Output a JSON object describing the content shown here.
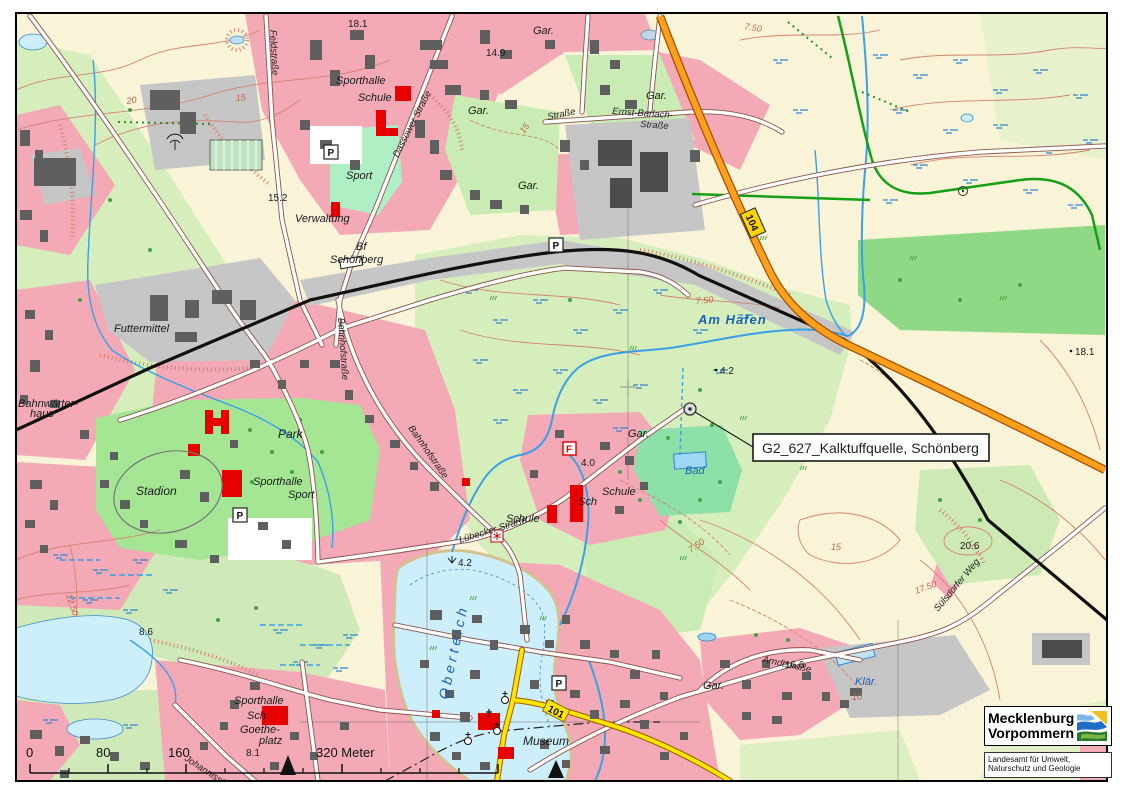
{
  "map": {
    "callout": "G2_627_Kalktuffquelle, Schönberg",
    "places": {
      "sporthalle": "Sporthalle",
      "schule": "Schule",
      "sport": "Sport",
      "verwaltung": "Verwaltung",
      "bf": "Bf",
      "schoenberg": "Schönberg",
      "futtermittel": "Futtermittel",
      "bahnwaerter": "Bahnwärter-",
      "haus": "haus",
      "park": "Park",
      "stadion": "Stadion",
      "sch": "Sch",
      "goethe": "Goethe-",
      "platz": "platz",
      "museum": "Museum",
      "gar": "Gar."
    },
    "water_labels": {
      "am_hafen": "Am Hafen",
      "oberteich": "Oberteich",
      "bad": "Bad",
      "klaer": "Klär."
    },
    "streets": {
      "dassower": "Dassower Straße",
      "ernst_barlach": "Ernst-Barlach-",
      "strasse": "Straße",
      "feld": "Feldstraße",
      "bahnhof": "Bahnhofstraße",
      "luebecker": "Lübecker Straße",
      "johannis": "Johannisstraße",
      "suelsdorfer": "Sülsdorfer Weg",
      "arndt": "Arndtstraße"
    },
    "heights": {
      "h181": "18.1",
      "h149": "14.9",
      "h152": "15.2",
      "h42": "4.2",
      "h40": "4.0",
      "h86": "8.6",
      "h81": "8.1",
      "h166": "16.6",
      "h206": "20.6"
    },
    "contours": {
      "c20": "20",
      "c15": "15",
      "c750": "7.50",
      "c1750": "17.50",
      "c1250": "12.50",
      "c10": "10"
    },
    "road_numbers": {
      "b104": "104",
      "l101": "101"
    },
    "symbols": {
      "parking": "P",
      "fire": "F"
    }
  },
  "scale_bar": {
    "t0": "0",
    "t80": "80",
    "t160": "160",
    "t320": "320 Meter"
  },
  "logo": {
    "line1": "Mecklenburg",
    "line2": "Vorpommern",
    "agency1": "Landesamt für Umwelt,",
    "agency2": "Naturschutz und Geologie"
  }
}
